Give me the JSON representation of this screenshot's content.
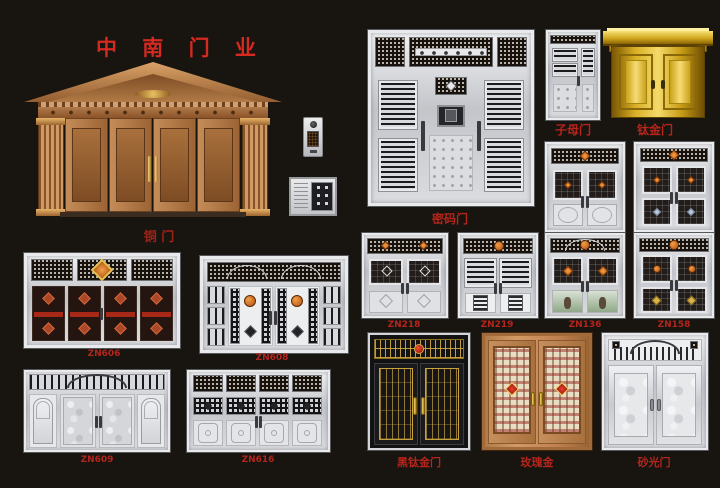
{
  "title": "中 南 门 业",
  "colors": {
    "background": "#181410",
    "label_red": "#b5251c",
    "title_red": "#d42a20",
    "copper": "#c08a58",
    "gold": "#e7b631",
    "silver": "#d9dbde",
    "ornament_orange": "#d2691e"
  },
  "products": {
    "copper_door": {
      "label": "铜 门"
    },
    "password_door": {
      "label": "密码门"
    },
    "zimu_door": {
      "label": "子母门"
    },
    "titanium_gold_door": {
      "label": "钛金门"
    },
    "zn606": {
      "label": "ZN606"
    },
    "zn608": {
      "label": "ZN608"
    },
    "zn218": {
      "label": "ZN218"
    },
    "zn219": {
      "label": "ZN219"
    },
    "zn136": {
      "label": "ZN136"
    },
    "zn158": {
      "label": "ZN158"
    },
    "zn609": {
      "label": "ZN609"
    },
    "zn616": {
      "label": "ZN616"
    },
    "black_titanium_door": {
      "label": "黑钛金门"
    },
    "rose_gold_door": {
      "label": "玫瑰金"
    },
    "sanded_door": {
      "label": "砂光门"
    }
  }
}
